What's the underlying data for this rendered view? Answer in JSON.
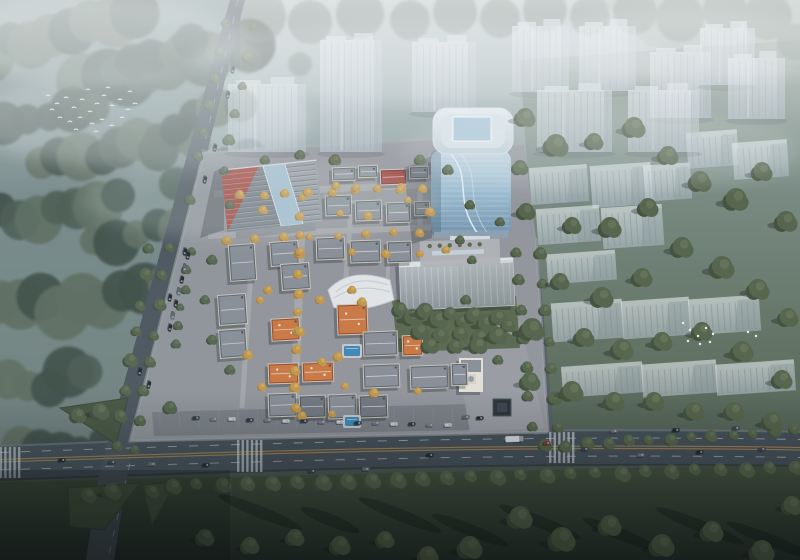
{
  "meta": {
    "title": "Aerial architectural rendering",
    "description": "Bird's-eye architectural rendering of a mixed-use development: a low-rise European-style village with gray and orange roofs, a curved blue-glass office tower, a striped-roof commercial hall, translucent ghosted residential towers and slabs to the north and east, misty forest to the west, and a main highway with vehicles across the bottom."
  },
  "palette": {
    "haze_top": "#bcc8c8",
    "forest_dark": "#3e4d45",
    "forest_mid": "#4d5c52",
    "forest_light": "#5e6e5f",
    "lawn_dark": "#26332a",
    "road": "#454f58",
    "lane_yellow": "#b08c4f",
    "lane_white": "#cdd5da",
    "site_ground": "#95979d",
    "roof_gray": "#8b919b",
    "roof_orange": "#cf7a42",
    "roof_red": "#a34038",
    "glass_blue": "#9dbfd4",
    "ghost_fill": "#dfe6ec",
    "pool_blue": "#3f8ab8",
    "tree_yellow": "#c59b4d",
    "car_dark": "#1d242b",
    "car_red": "#8c2f2a",
    "truck_white": "#dde2e6",
    "bird_white": "#f4f7f8"
  },
  "scene": {
    "bands": [
      [
        60,
        30,
        75,
        20,
        -18
      ],
      [
        165,
        62,
        85,
        22,
        -14
      ],
      [
        38,
        118,
        58,
        18,
        -8
      ],
      [
        120,
        150,
        80,
        20,
        -10
      ],
      [
        48,
        212,
        70,
        22,
        -6
      ],
      [
        148,
        232,
        58,
        18,
        -12
      ],
      [
        82,
        300,
        85,
        24,
        -8
      ],
      [
        28,
        382,
        62,
        20,
        -4
      ],
      [
        196,
        118,
        46,
        16,
        -18
      ],
      [
        214,
        170,
        40,
        14,
        -14
      ],
      [
        60,
        445,
        42,
        16,
        -6
      ],
      [
        152,
        58,
        42,
        14,
        -20
      ]
    ],
    "top_trees": [
      [
        260,
        16,
        26
      ],
      [
        310,
        22,
        22
      ],
      [
        360,
        14,
        24
      ],
      [
        410,
        20,
        20
      ],
      [
        455,
        12,
        22
      ],
      [
        500,
        18,
        20
      ],
      [
        545,
        10,
        22
      ],
      [
        590,
        16,
        20
      ],
      [
        635,
        12,
        22
      ],
      [
        680,
        18,
        24
      ],
      [
        725,
        10,
        22
      ],
      [
        768,
        16,
        24
      ],
      [
        795,
        42,
        18
      ],
      [
        248,
        60,
        14
      ],
      [
        300,
        64,
        12
      ]
    ],
    "ghost_towers": [
      [
        228,
        84,
        78,
        68
      ],
      [
        320,
        40,
        62,
        112
      ],
      [
        412,
        42,
        64,
        70
      ],
      [
        512,
        26,
        57,
        66
      ],
      [
        579,
        26,
        57,
        65
      ],
      [
        650,
        52,
        61,
        66
      ],
      [
        700,
        28,
        55,
        57
      ],
      [
        728,
        58,
        57,
        61
      ],
      [
        537,
        90,
        75,
        62
      ],
      [
        628,
        90,
        71,
        62
      ]
    ],
    "ghost_slabs": [
      [
        530,
        166,
        58,
        37
      ],
      [
        591,
        164,
        61,
        42
      ],
      [
        644,
        164,
        47,
        36
      ],
      [
        537,
        207,
        63,
        36
      ],
      [
        602,
        206,
        61,
        41
      ],
      [
        547,
        252,
        69,
        30
      ],
      [
        552,
        301,
        71,
        39
      ],
      [
        622,
        299,
        68,
        38
      ],
      [
        689,
        297,
        71,
        36
      ],
      [
        562,
        364,
        81,
        31
      ],
      [
        642,
        362,
        75,
        33
      ],
      [
        716,
        362,
        79,
        31
      ],
      [
        687,
        131,
        51,
        36
      ],
      [
        733,
        141,
        55,
        37
      ]
    ],
    "villas": [
      [
        332,
        167,
        24,
        14,
        "gray"
      ],
      [
        358,
        165,
        20,
        13,
        "gray"
      ],
      [
        380,
        169,
        27,
        16,
        "red"
      ],
      [
        409,
        166,
        20,
        13,
        "gray"
      ],
      [
        431,
        159,
        22,
        12,
        "gray"
      ],
      [
        325,
        195,
        27,
        21,
        "gray"
      ],
      [
        355,
        200,
        27,
        21,
        "gray"
      ],
      [
        386,
        202,
        25,
        21,
        "gray"
      ],
      [
        414,
        201,
        16,
        15,
        "gray"
      ],
      [
        316,
        237,
        29,
        23,
        "gray"
      ],
      [
        350,
        240,
        31,
        23,
        "gray"
      ],
      [
        387,
        241,
        25,
        22,
        "gray"
      ],
      [
        229,
        244,
        27,
        37,
        "gray",
        -4
      ],
      [
        270,
        241,
        29,
        25,
        "gray",
        -4
      ],
      [
        281,
        263,
        29,
        27,
        "gray",
        -4
      ],
      [
        218,
        294,
        29,
        31,
        "gray",
        -4
      ],
      [
        219,
        329,
        28,
        29,
        "gray",
        -4
      ],
      [
        271,
        318,
        29,
        23,
        "orange",
        -3
      ],
      [
        337,
        304,
        31,
        31,
        "orange"
      ],
      [
        402,
        335,
        21,
        21,
        "orange"
      ],
      [
        268,
        363,
        31,
        21,
        "orange"
      ],
      [
        302,
        362,
        32,
        20,
        "orange"
      ],
      [
        363,
        331,
        35,
        25,
        "gray"
      ],
      [
        363,
        364,
        37,
        24,
        "gray"
      ],
      [
        410,
        365,
        39,
        24,
        "gray"
      ],
      [
        451,
        363,
        17,
        23,
        "gray"
      ],
      [
        268,
        393,
        29,
        24,
        "gray"
      ],
      [
        299,
        395,
        27,
        23,
        "slate"
      ],
      [
        328,
        394,
        29,
        25,
        "gray"
      ],
      [
        359,
        395,
        29,
        23,
        "slate"
      ]
    ],
    "right_trees": [
      [
        525,
        118,
        10
      ],
      [
        556,
        146,
        12
      ],
      [
        594,
        142,
        9
      ],
      [
        634,
        128,
        11
      ],
      [
        668,
        156,
        10
      ],
      [
        700,
        182,
        11
      ],
      [
        736,
        200,
        12
      ],
      [
        762,
        172,
        10
      ],
      [
        786,
        222,
        11
      ],
      [
        648,
        208,
        10
      ],
      [
        610,
        228,
        11
      ],
      [
        572,
        226,
        9
      ],
      [
        682,
        248,
        11
      ],
      [
        722,
        268,
        12
      ],
      [
        758,
        290,
        11
      ],
      [
        788,
        318,
        10
      ],
      [
        642,
        278,
        10
      ],
      [
        602,
        298,
        11
      ],
      [
        560,
        282,
        9
      ],
      [
        532,
        330,
        12
      ],
      [
        584,
        338,
        10
      ],
      [
        622,
        350,
        11
      ],
      [
        662,
        342,
        10
      ],
      [
        702,
        332,
        10
      ],
      [
        742,
        352,
        11
      ],
      [
        782,
        380,
        10
      ],
      [
        530,
        382,
        10
      ],
      [
        572,
        392,
        11
      ],
      [
        614,
        402,
        10
      ],
      [
        654,
        402,
        10
      ],
      [
        694,
        412,
        10
      ],
      [
        734,
        412,
        10
      ],
      [
        772,
        422,
        10
      ],
      [
        526,
        212,
        9
      ],
      [
        520,
        168,
        8
      ]
    ],
    "park_trees": [
      [
        400,
        310
      ],
      [
        412,
        318
      ],
      [
        425,
        312
      ],
      [
        438,
        320
      ],
      [
        450,
        314
      ],
      [
        462,
        322
      ],
      [
        474,
        316
      ],
      [
        486,
        324
      ],
      [
        498,
        318
      ],
      [
        508,
        326
      ],
      [
        420,
        332
      ],
      [
        440,
        336
      ],
      [
        460,
        334
      ],
      [
        480,
        338
      ],
      [
        497,
        336
      ],
      [
        430,
        346
      ],
      [
        455,
        347
      ],
      [
        478,
        346
      ]
    ],
    "lawn_trees": [
      [
        520,
        518,
        12
      ],
      [
        562,
        540,
        13
      ],
      [
        610,
        526,
        11
      ],
      [
        662,
        546,
        12
      ],
      [
        712,
        532,
        11
      ],
      [
        762,
        552,
        12
      ],
      [
        792,
        506,
        10
      ],
      [
        470,
        548,
        12
      ],
      [
        428,
        556,
        10
      ],
      [
        385,
        540,
        9
      ],
      [
        340,
        546,
        10
      ],
      [
        295,
        538,
        9
      ],
      [
        250,
        546,
        9
      ],
      [
        205,
        538,
        9
      ]
    ],
    "tree_rows": [
      [
        172,
        486,
        795,
        468,
        26,
        7,
        "g"
      ],
      [
        545,
        447,
        795,
        431,
        13,
        5.5,
        "g"
      ],
      [
        150,
        248,
        116,
        446,
        8,
        6,
        "g"
      ],
      [
        168,
        248,
        134,
        450,
        8,
        5.5,
        "g"
      ],
      [
        224,
        24,
        198,
        158,
        6,
        5,
        "g"
      ],
      [
        253,
        28,
        224,
        170,
        6,
        5,
        "g"
      ],
      [
        516,
        252,
        531,
        426,
        7,
        5.5,
        "g"
      ],
      [
        541,
        254,
        557,
        428,
        7,
        6,
        "g"
      ],
      [
        301,
        198,
        295,
        408,
        12,
        4.5,
        "y"
      ],
      [
        240,
        196,
        424,
        188,
        9,
        4,
        "y"
      ],
      [
        228,
        240,
        420,
        232,
        8,
        4,
        "y"
      ],
      [
        190,
        252,
        176,
        344,
        6,
        4,
        "g"
      ]
    ],
    "yellow_scatter": [
      [
        263,
        210
      ],
      [
        340,
        213
      ],
      [
        368,
        216
      ],
      [
        268,
        290
      ],
      [
        320,
        300
      ],
      [
        352,
        290
      ],
      [
        248,
        355
      ],
      [
        338,
        357
      ],
      [
        362,
        302
      ],
      [
        300,
        332
      ],
      [
        322,
        362
      ],
      [
        262,
        387
      ],
      [
        345,
        386
      ],
      [
        374,
        393
      ],
      [
        418,
        391
      ],
      [
        302,
        416
      ],
      [
        332,
        414
      ],
      [
        408,
        200
      ],
      [
        430,
        212
      ],
      [
        352,
        252
      ],
      [
        386,
        254
      ],
      [
        420,
        254
      ],
      [
        446,
        250
      ],
      [
        300,
        252
      ],
      [
        260,
        300
      ],
      [
        336,
        186
      ],
      [
        356,
        188
      ],
      [
        400,
        190
      ]
    ],
    "green_scatter": [
      [
        230,
        205
      ],
      [
        212,
        260
      ],
      [
        205,
        300
      ],
      [
        212,
        340
      ],
      [
        230,
        370
      ],
      [
        420,
        160
      ],
      [
        448,
        170
      ],
      [
        300,
        155
      ],
      [
        265,
        160
      ],
      [
        190,
        200
      ],
      [
        460,
        240
      ],
      [
        466,
        300
      ],
      [
        472,
        260
      ],
      [
        470,
        205
      ],
      [
        335,
        160
      ],
      [
        500,
        222
      ],
      [
        505,
        320
      ],
      [
        498,
        360
      ]
    ],
    "islands": [
      "60,408 128,398 116,444",
      "162,400 196,398 170,436",
      "68,488 140,483 104,530 70,526",
      "142,485 176,482 152,525"
    ],
    "island_trees": [
      [
        78,
        416,
        8
      ],
      [
        100,
        412,
        9
      ],
      [
        170,
        408,
        7
      ],
      [
        88,
        496,
        8
      ],
      [
        112,
        492,
        9
      ],
      [
        152,
        492,
        7
      ]
    ],
    "streets": [
      [
        214,
        194,
        446,
        184,
        7
      ],
      [
        208,
        236,
        442,
        227,
        6
      ],
      [
        303,
        190,
        294,
        414,
        8
      ],
      [
        253,
        240,
        242,
        408,
        5
      ],
      [
        352,
        200,
        344,
        300,
        5
      ],
      [
        390,
        242,
        386,
        300,
        4
      ],
      [
        158,
        420,
        470,
        410,
        9
      ],
      [
        420,
        186,
        420,
        230,
        5
      ]
    ],
    "pools": [
      [
        344,
        346,
        16,
        10
      ],
      [
        345,
        417,
        14,
        9
      ]
    ],
    "cars_main": [
      [
        62,
        460
      ],
      [
        112,
        462
      ],
      [
        152,
        464
      ],
      [
        206,
        465
      ],
      [
        312,
        471
      ],
      [
        366,
        469
      ],
      [
        430,
        455
      ],
      [
        585,
        449
      ],
      [
        641,
        455
      ],
      [
        700,
        452
      ],
      [
        762,
        449
      ],
      [
        614,
        431
      ],
      [
        676,
        430
      ],
      [
        736,
        428
      ]
    ],
    "car_red": [
      547,
      443
    ],
    "truck": [
      514,
      439
    ],
    "cars_vertical": [
      [
        140,
        372
      ],
      [
        149,
        385
      ],
      [
        170,
        298
      ],
      [
        185,
        252
      ],
      [
        205,
        180
      ],
      [
        215,
        148
      ],
      [
        228,
        95
      ],
      [
        233,
        70
      ]
    ],
    "parked_west": [
      [
        188,
        256
      ],
      [
        185,
        268
      ],
      [
        182,
        280
      ],
      [
        179,
        292
      ],
      [
        176,
        304
      ],
      [
        173,
        316
      ],
      [
        170,
        328
      ]
    ],
    "parked_south": [
      [
        196,
        418
      ],
      [
        214,
        419
      ],
      [
        232,
        419
      ],
      [
        250,
        420
      ],
      [
        268,
        420
      ],
      [
        286,
        421
      ],
      [
        304,
        421
      ],
      [
        322,
        422
      ],
      [
        340,
        422
      ],
      [
        358,
        423
      ],
      [
        376,
        423
      ],
      [
        394,
        424
      ],
      [
        412,
        424
      ],
      [
        430,
        425
      ],
      [
        448,
        425
      ]
    ],
    "cars_plaza": [
      [
        480,
        418
      ],
      [
        466,
        417
      ]
    ],
    "birds_flock": [
      [
        48,
        96
      ],
      [
        57,
        104
      ],
      [
        66,
        98
      ],
      [
        74,
        108
      ],
      [
        82,
        100
      ],
      [
        90,
        112
      ],
      [
        97,
        104
      ],
      [
        104,
        96
      ],
      [
        112,
        106
      ],
      [
        120,
        100
      ],
      [
        128,
        110
      ],
      [
        135,
        104
      ],
      [
        60,
        118
      ],
      [
        70,
        122
      ],
      [
        80,
        118
      ],
      [
        92,
        124
      ],
      [
        102,
        120
      ],
      [
        112,
        126
      ],
      [
        122,
        118
      ],
      [
        52,
        110
      ],
      [
        88,
        90
      ],
      [
        108,
        88
      ],
      [
        76,
        130
      ],
      [
        96,
        132
      ],
      [
        130,
        92
      ]
    ],
    "birds_lawn": [
      [
        683,
        323
      ],
      [
        690,
        330
      ],
      [
        698,
        336
      ],
      [
        706,
        328
      ],
      [
        713,
        334
      ],
      [
        688,
        341
      ],
      [
        700,
        344
      ],
      [
        710,
        342
      ],
      [
        748,
        332
      ],
      [
        756,
        336
      ]
    ],
    "shadow_streaks": [
      [
        260,
        512
      ],
      [
        330,
        520
      ],
      [
        400,
        515
      ],
      [
        470,
        530
      ],
      [
        540,
        522
      ],
      [
        620,
        534
      ],
      [
        700,
        526
      ],
      [
        770,
        540
      ]
    ]
  }
}
